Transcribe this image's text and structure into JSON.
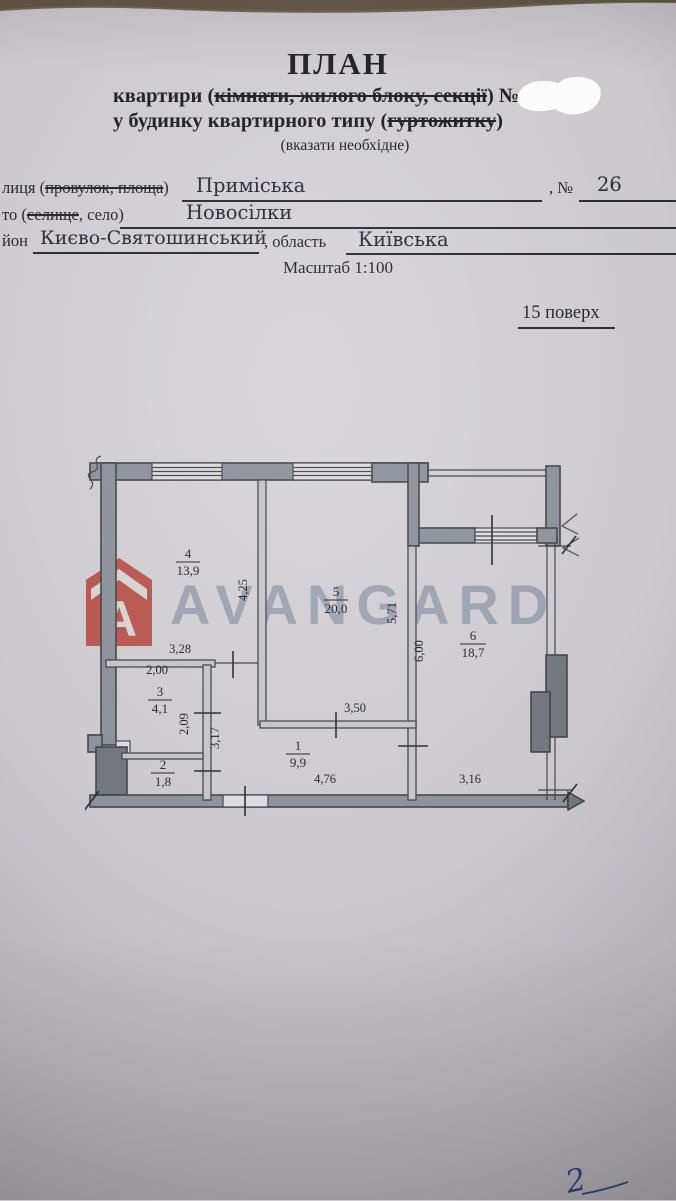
{
  "header": {
    "title": "ПЛАН",
    "subject_pre": "квартири (",
    "subject_struck": "кімнати, жилого блоку, секції",
    "subject_post": ") №",
    "building_pre": "у будинку квартирного типу (",
    "building_struck": "гуртожитку",
    "building_post": ")",
    "note": "(вказати необхідне)"
  },
  "address": {
    "street_label_pre": "лиця (",
    "street_label_struck": "провулок, площа",
    "street_label_post": ")",
    "street_value": "Приміська",
    "number_label": ", №",
    "number_value": "26",
    "settlement_label_pre": "то (",
    "settlement_label_struck": "селище",
    "settlement_label_post": ", село)",
    "settlement_value": "Новосілки",
    "district_label": "йон",
    "district_value": "Києво-Святошинський",
    "region_label": ", область",
    "region_value": "Київська",
    "scale": "Масштаб 1:100",
    "floor": "15 поверх"
  },
  "watermark": {
    "brand": "AVANGARD",
    "logo_letter": "A",
    "logo_color": "#b5443c",
    "text_color": "#6e7a92"
  },
  "plan": {
    "rooms": [
      {
        "num": "4",
        "area": "13,9"
      },
      {
        "num": "5",
        "area": "20,0"
      },
      {
        "num": "6",
        "area": "18,7"
      },
      {
        "num": "3",
        "area": "4,1"
      },
      {
        "num": "2",
        "area": "1,8"
      },
      {
        "num": "1",
        "area": "9,9"
      }
    ],
    "dims": {
      "left_room_height": "4,25",
      "left_room_width": "3,28",
      "room3_width": "2,00",
      "room3_height": "2,09",
      "hall_height": "3,17",
      "kitchen_wall": "3,50",
      "living_height": "5,71",
      "right_room_height": "6,00",
      "hall_width": "4,76",
      "right_width": "3,16"
    }
  },
  "annotations": {
    "handwritten_mark": "2"
  }
}
